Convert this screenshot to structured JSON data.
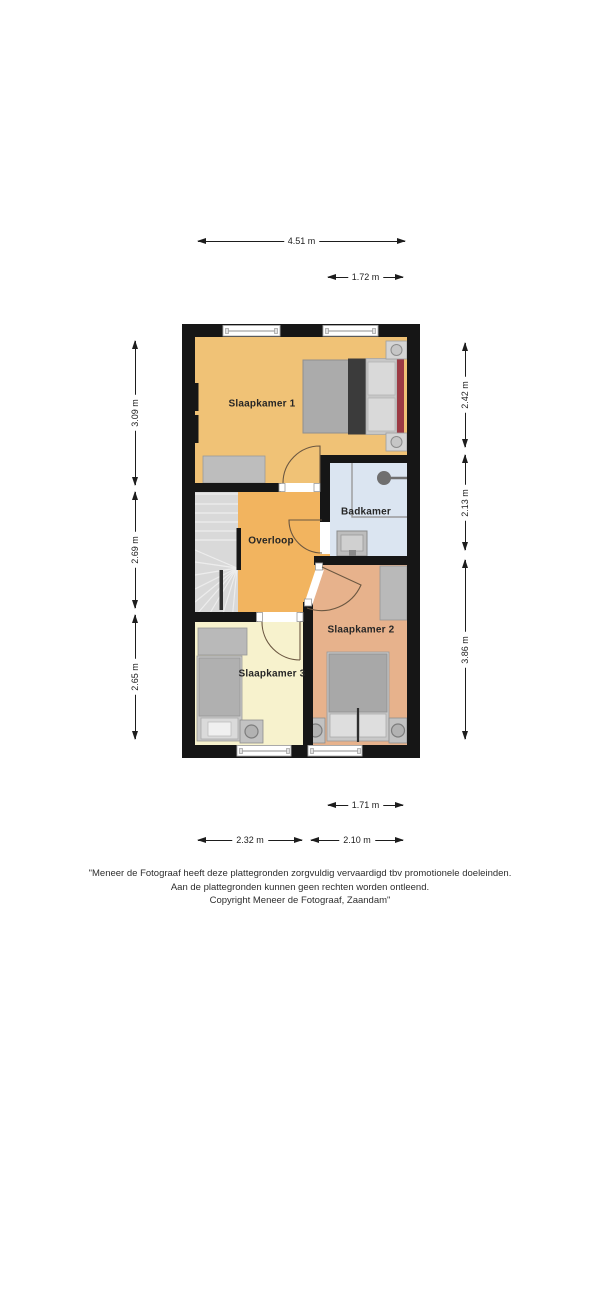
{
  "floorplan": {
    "rooms": [
      {
        "name": "Slaapkamer 1",
        "color": "#f0c276"
      },
      {
        "name": "Overloop",
        "color": "#f2b45f"
      },
      {
        "name": "Badkamer",
        "color": "#dbe5f1"
      },
      {
        "name": "Slaapkamer 2",
        "color": "#e7b28c"
      },
      {
        "name": "Slaapkamer 3",
        "color": "#f7f2cd"
      }
    ],
    "dimensions": {
      "top_width": "4.51 m",
      "top_right_width": "1.72 m",
      "left_top": "3.09 m",
      "left_middle": "2.69 m",
      "left_bottom": "2.65 m",
      "right_top": "2.42 m",
      "right_middle": "2.13 m",
      "right_bottom": "3.86 m",
      "bottom_inner_right": "1.71 m",
      "bottom_left": "2.32 m",
      "bottom_right": "2.10 m"
    },
    "colors": {
      "wall": "#161616",
      "stairs": "#d9d9d9",
      "furniture": "#b9b9b9",
      "bed_dark_band": "#3b3b3b",
      "bed_red_accent": "#9c3a44",
      "background": "#ffffff"
    }
  },
  "disclaimer": {
    "line1": "\"Meneer de Fotograaf heeft deze plattegronden zorgvuldig vervaardigd tbv promotionele doeleinden.",
    "line2": "Aan de plattegronden kunnen geen rechten worden ontleend.",
    "line3": "Copyright Meneer de Fotograaf, Zaandam\""
  }
}
